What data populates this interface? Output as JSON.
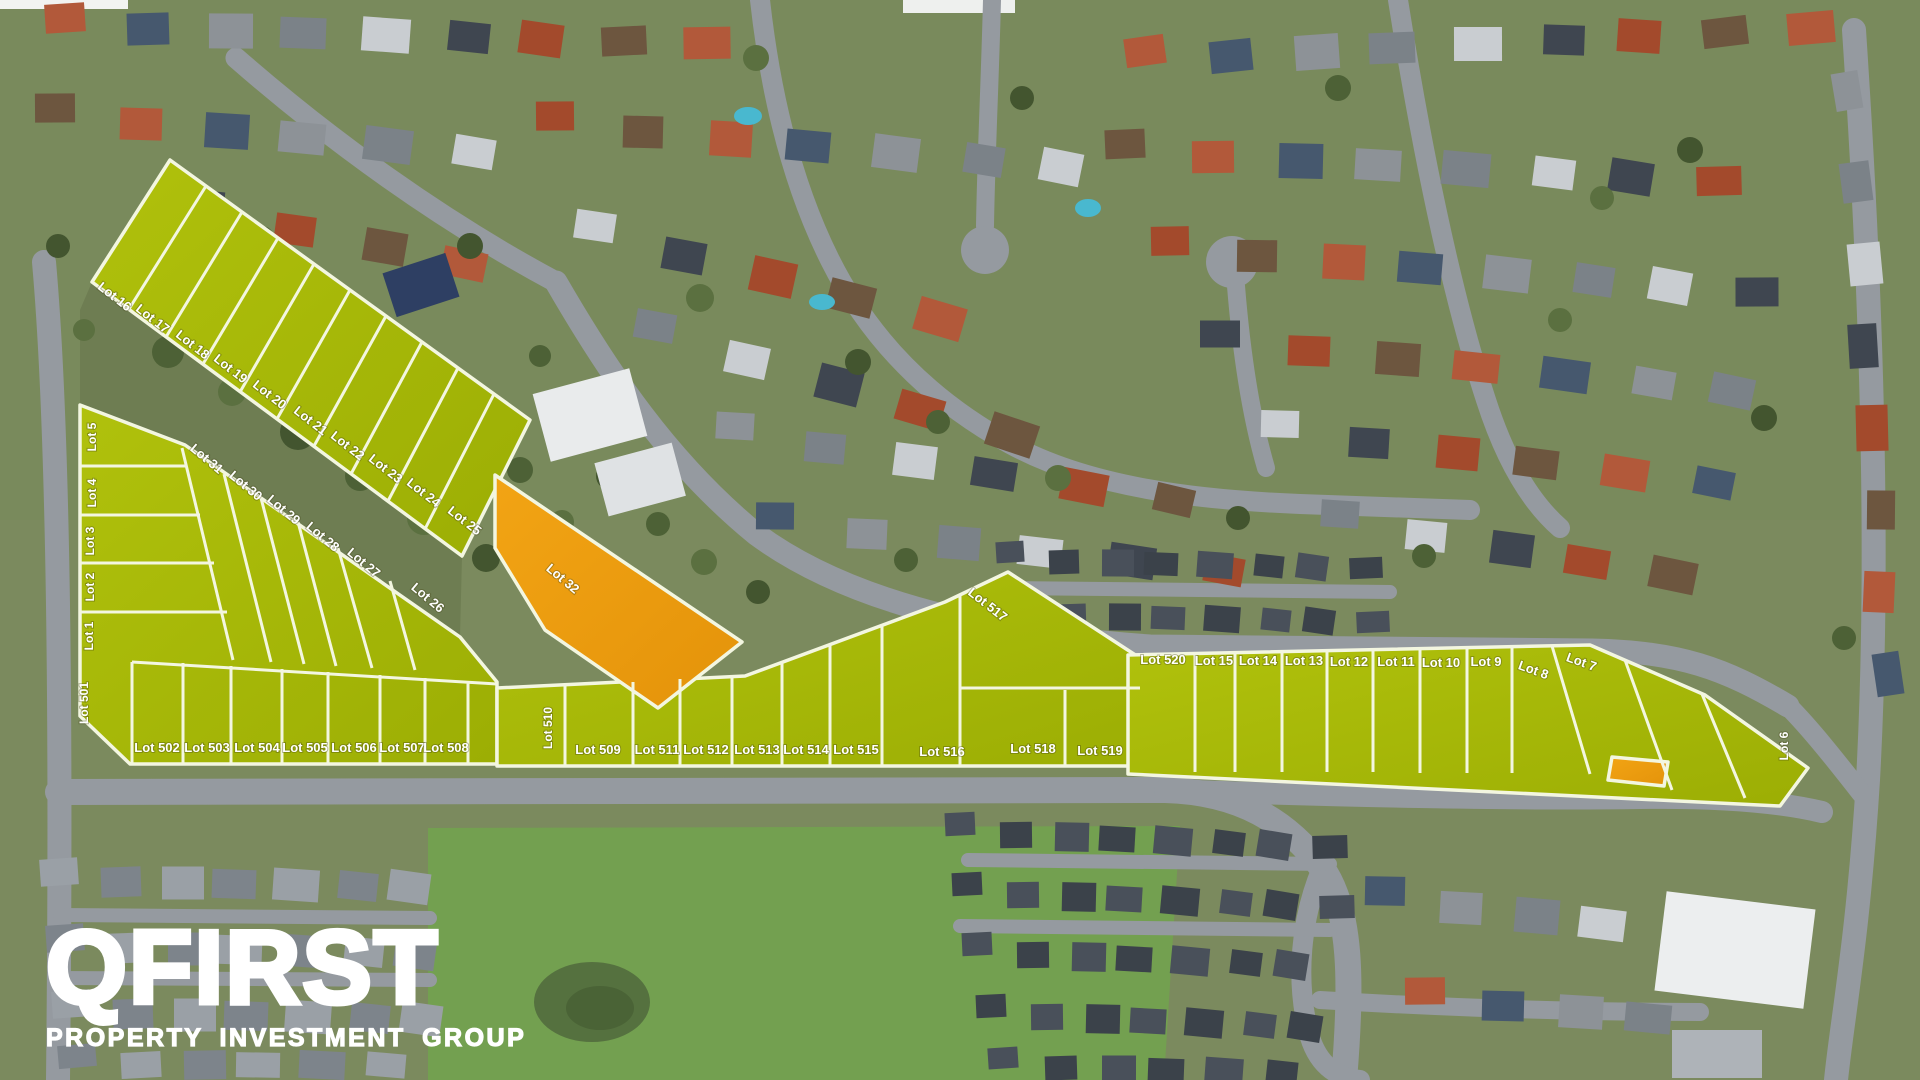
{
  "branding": {
    "logo": "QFIRST",
    "tagline": "PROPERTY INVESTMENT GROUP",
    "logo_color": "#ffffff"
  },
  "map": {
    "type": "aerial-subdivision-masterplan",
    "colors": {
      "available_lot_fill": "#a9ba08",
      "highlighted_lot_fill": "#ee9d0e",
      "lot_border": "#f3f6e0"
    }
  },
  "lots": [
    {
      "label": "Lot 16"
    },
    {
      "label": "Lot 17"
    },
    {
      "label": "Lot 18"
    },
    {
      "label": "Lot 19"
    },
    {
      "label": "Lot 20"
    },
    {
      "label": "Lot 21"
    },
    {
      "label": "Lot 22"
    },
    {
      "label": "Lot 23"
    },
    {
      "label": "Lot 24"
    },
    {
      "label": "Lot 25"
    },
    {
      "label": "Lot 5"
    },
    {
      "label": "Lot 4"
    },
    {
      "label": "Lot 3"
    },
    {
      "label": "Lot 2"
    },
    {
      "label": "Lot 1"
    },
    {
      "label": "Lot 31"
    },
    {
      "label": "Lot 30"
    },
    {
      "label": "Lot 29"
    },
    {
      "label": "Lot 28"
    },
    {
      "label": "Lot 27"
    },
    {
      "label": "Lot 26"
    },
    {
      "label": "Lot 32"
    },
    {
      "label": "Lot 501"
    },
    {
      "label": "Lot 502"
    },
    {
      "label": "Lot 503"
    },
    {
      "label": "Lot 504"
    },
    {
      "label": "Lot 505"
    },
    {
      "label": "Lot 506"
    },
    {
      "label": "Lot 507"
    },
    {
      "label": "Lot 508"
    },
    {
      "label": "Lot 510"
    },
    {
      "label": "Lot 509"
    },
    {
      "label": "Lot 511"
    },
    {
      "label": "Lot 512"
    },
    {
      "label": "Lot 513"
    },
    {
      "label": "Lot 514"
    },
    {
      "label": "Lot 515"
    },
    {
      "label": "Lot 516"
    },
    {
      "label": "Lot 517"
    },
    {
      "label": "Lot 518"
    },
    {
      "label": "Lot 519"
    },
    {
      "label": "Lot 520"
    },
    {
      "label": "Lot 15"
    },
    {
      "label": "Lot 14"
    },
    {
      "label": "Lot 13"
    },
    {
      "label": "Lot 12"
    },
    {
      "label": "Lot 11"
    },
    {
      "label": "Lot 10"
    },
    {
      "label": "Lot 9"
    },
    {
      "label": "Lot 8"
    },
    {
      "label": "Lot 7"
    },
    {
      "label": "Lot 6"
    }
  ]
}
